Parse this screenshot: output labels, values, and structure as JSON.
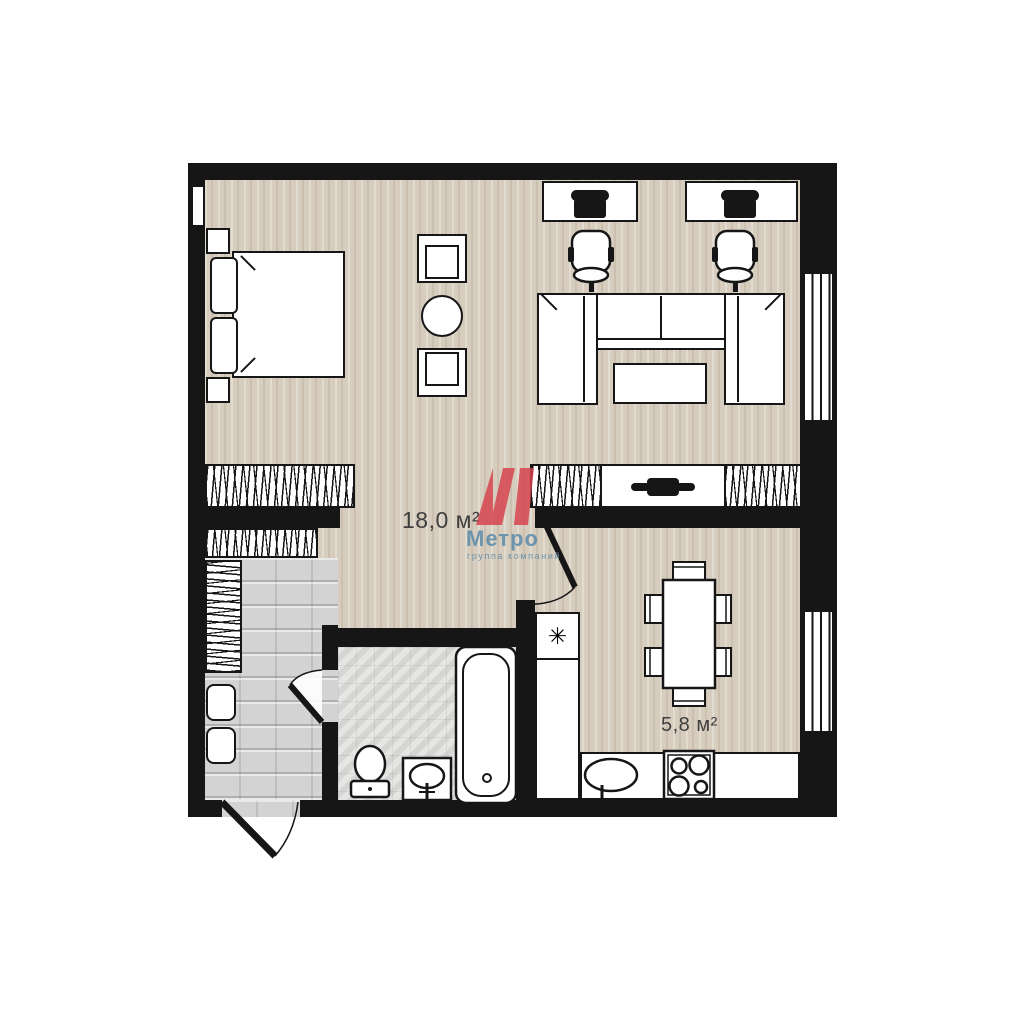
{
  "branding": {
    "logo_letter": "М",
    "logo_name": "Метро",
    "logo_tagline": "группа компаний"
  },
  "rooms": {
    "living": {
      "area_label": "18,0 м²"
    },
    "kitchen": {
      "area_label": "5,8 м²"
    }
  },
  "symbols": {
    "fridge_freezer": "✳"
  },
  "colors": {
    "wall": "#161616",
    "floor_wood": "#d7cdbe",
    "floor_hall": "#d3d3d3",
    "floor_tile": "#dcdcda",
    "logo_red": "#d5434d",
    "logo_blue": "#5f8cab",
    "label_text": "#3f3f3f"
  }
}
